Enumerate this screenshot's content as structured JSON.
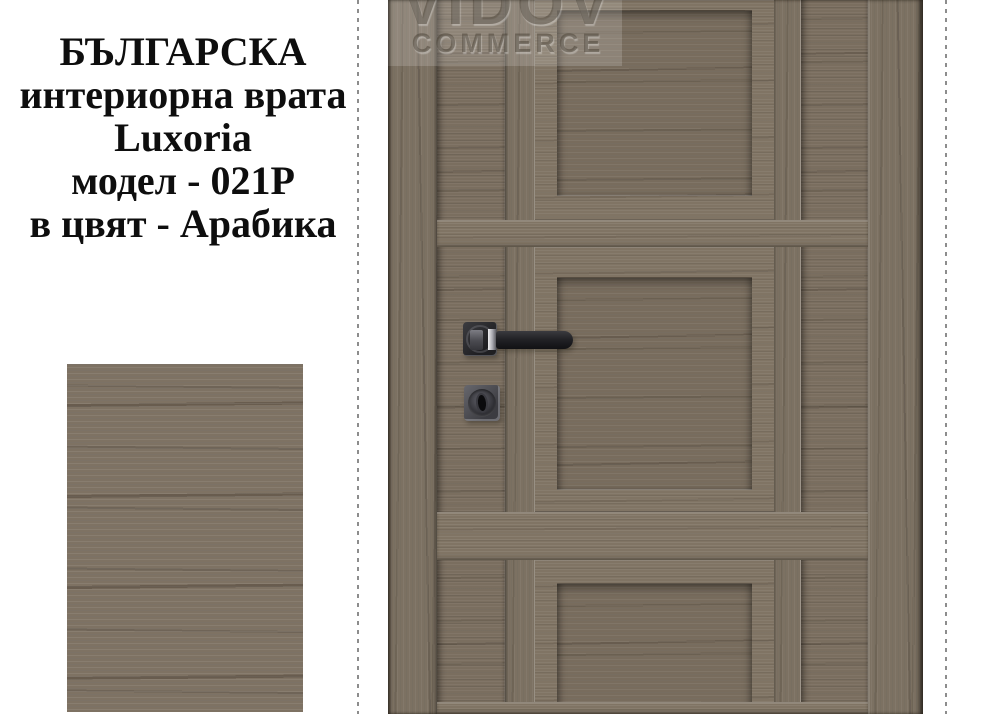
{
  "background": "#ffffff",
  "product_text": {
    "lines": [
      "БЪЛГАРСКА",
      "интериорна врата",
      "Luxoria",
      "модел - 021P",
      "в цвят - Арабика"
    ]
  },
  "watermark": {
    "brand": "VIDOV",
    "sub": "COMMERCE"
  },
  "door": {
    "description": "interior door leaf with three recessed panels, handle and lock",
    "color_name_shown_in_text": "Арабика"
  },
  "colors": {
    "wood_base": "#7a6e5f",
    "wood_frame": "#807464",
    "wood_recess": "#786c5d",
    "wood_dark_streak": "#564b3e",
    "wood_light_streak": "#968a79",
    "swatch_base": "#7e7263",
    "hardware_black": "#1e1e21",
    "hardware_gray": "#55555b",
    "chrome": "#d8d8dc",
    "dashed_line": "#8d8d8d",
    "text": "#0e0e0e",
    "watermark_text": "rgba(72,63,52,0.5)"
  }
}
